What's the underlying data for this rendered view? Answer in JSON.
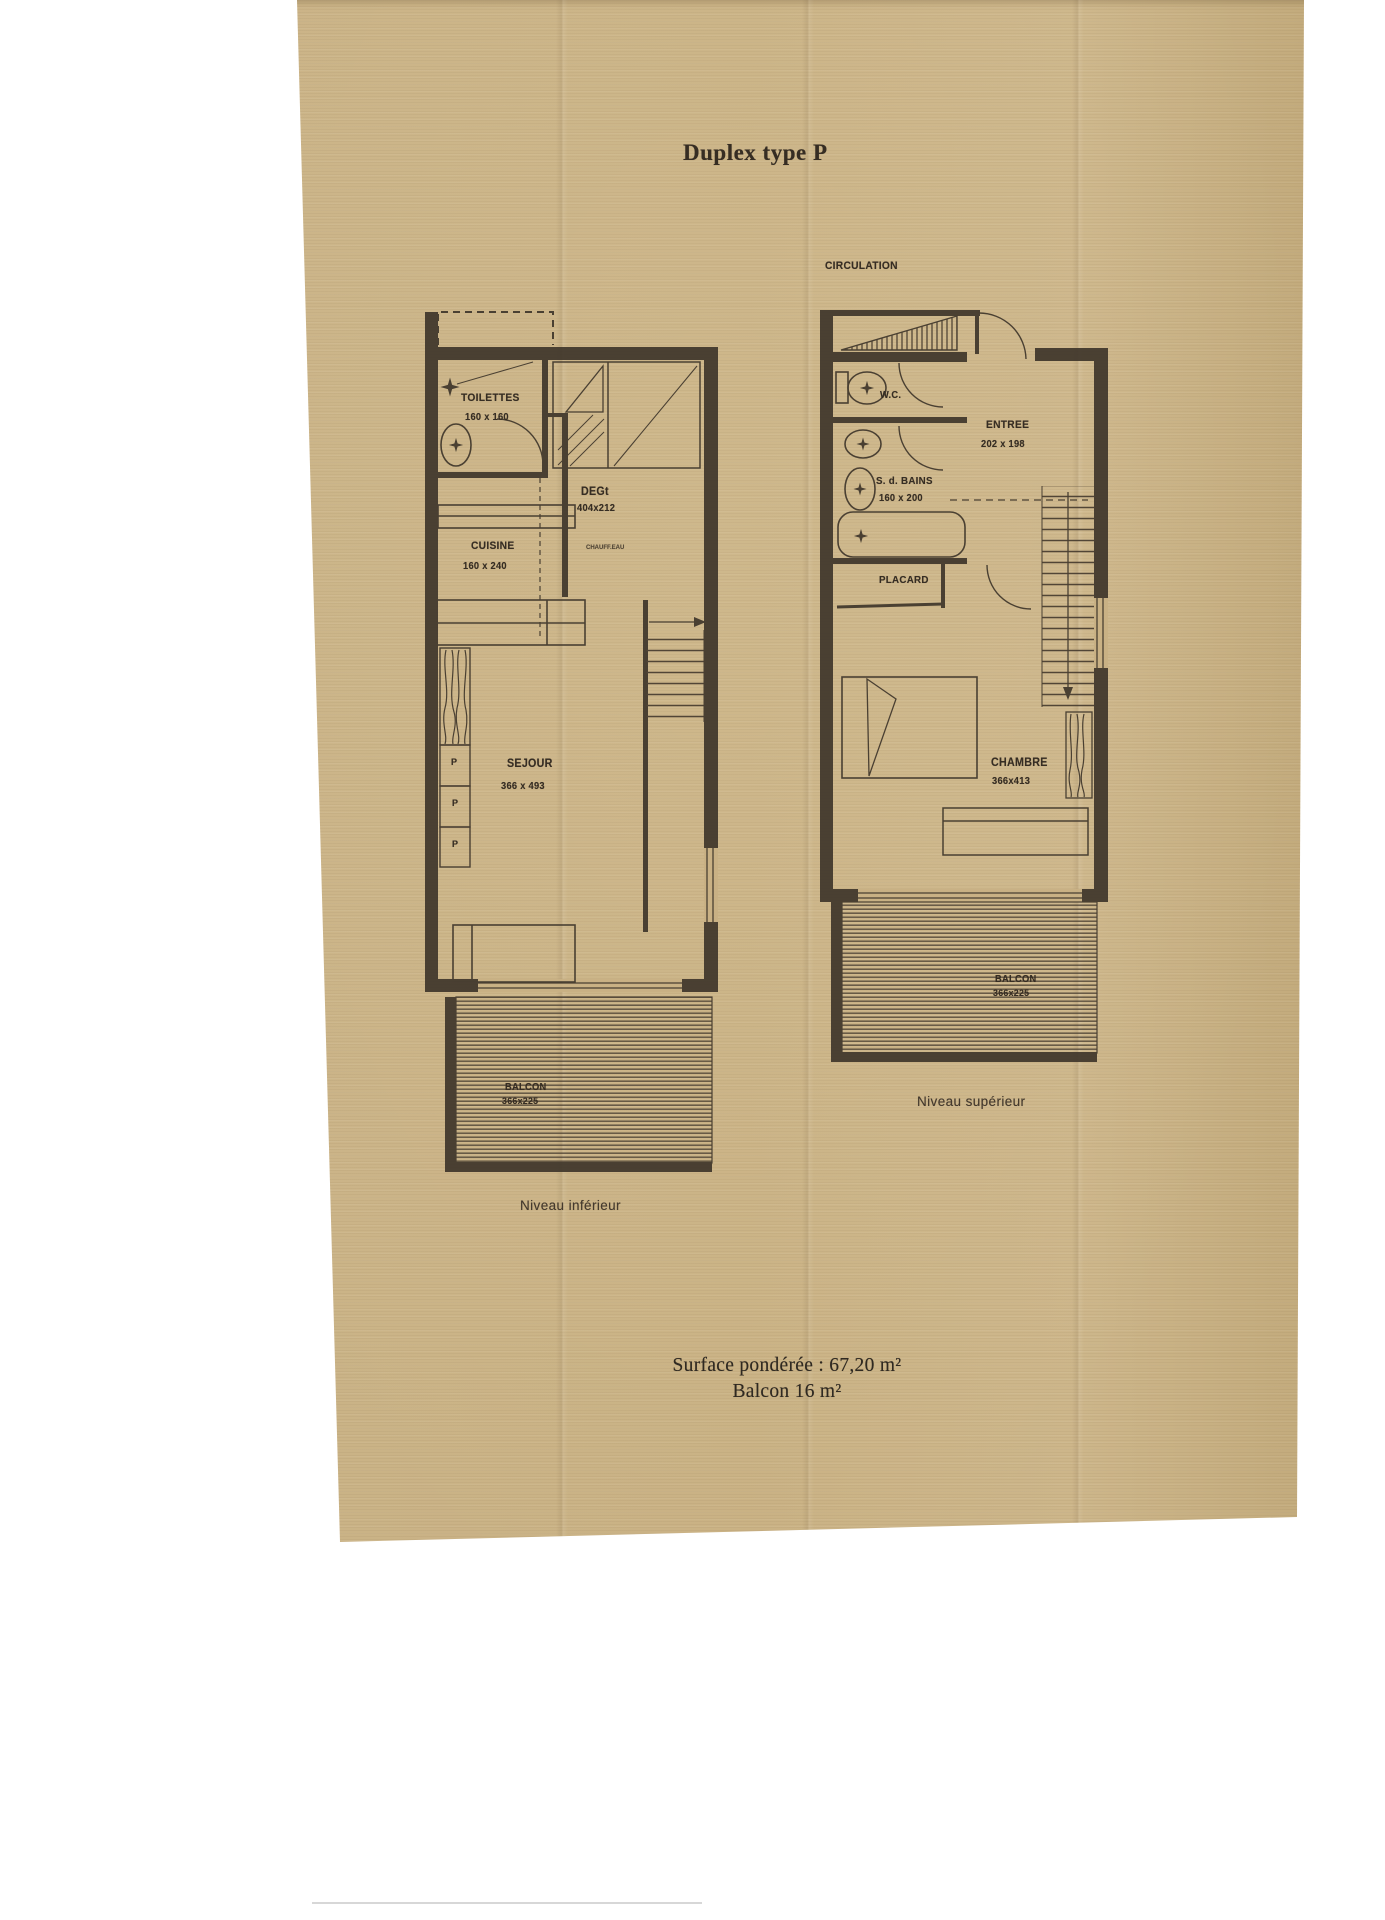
{
  "page": {
    "title": "Duplex type P"
  },
  "lower_plan": {
    "level_label": "Niveau inférieur",
    "toilettes_name": "TOILETTES",
    "toilettes_dim": "160 x 160",
    "cuisine_name": "CUISINE",
    "cuisine_dim": "160 x 240",
    "deg_name": "DEGt",
    "deg_dim": "404x212",
    "deg_note": "CHAUFF.EAU",
    "sejour_name": "SEJOUR",
    "sejour_dim": "366 x 493",
    "balcon_name": "BALCON",
    "balcon_dim": "366x225",
    "placard_marks": [
      "P",
      "P",
      "P"
    ]
  },
  "upper_plan": {
    "level_label": "Niveau supérieur",
    "circulation_label": "CIRCULATION",
    "wc_name": "W.C.",
    "sdb_name": "S. d. BAINS",
    "sdb_dim": "160 x 200",
    "entree_name": "ENTREE",
    "entree_dim": "202 x 198",
    "placard_name": "PLACARD",
    "chambre_name": "CHAMBRE",
    "chambre_dim": "366x413",
    "balcon_name": "BALCON",
    "balcon_dim": "366x225"
  },
  "summary": {
    "surface_line": "Surface pondérée : 67,20 m²",
    "balcon_line": "Balcon 16 m²"
  },
  "colors": {
    "paper": "#c9b184",
    "ink": "#3a3127"
  }
}
